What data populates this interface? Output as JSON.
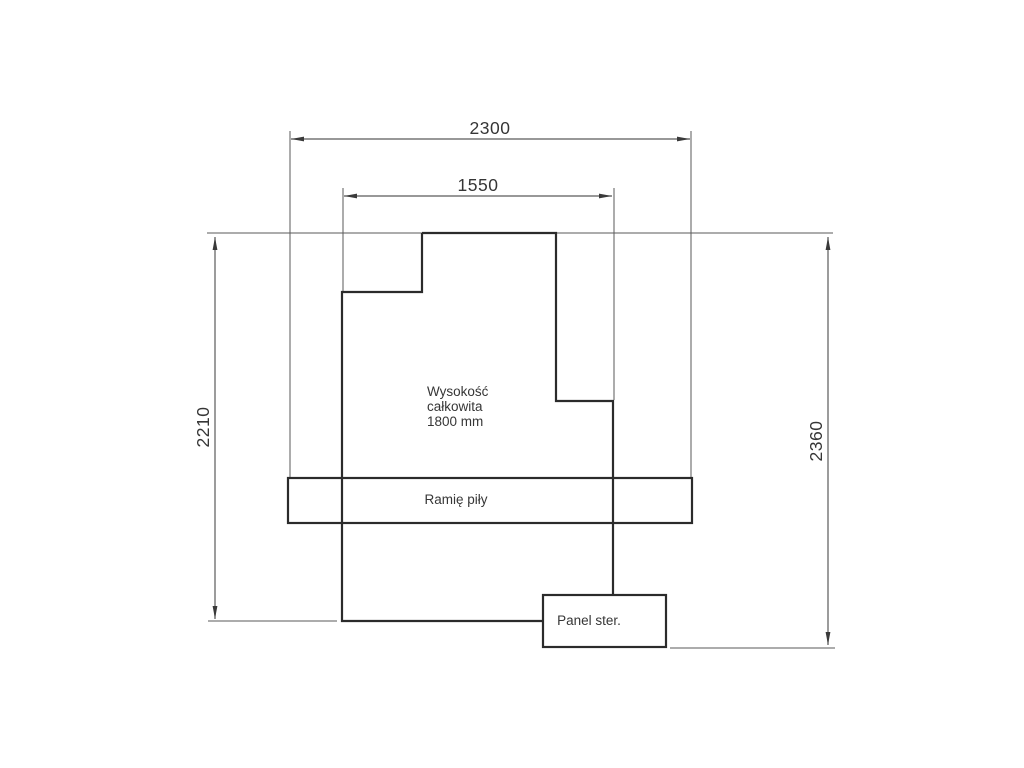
{
  "drawing": {
    "type": "technical-dimension-diagram",
    "dimensions": {
      "width_outer": "2300",
      "width_base": "1550",
      "height_body": "2210",
      "height_total": "2360"
    },
    "note": {
      "line1": "Wysokość",
      "line2": "całkowita",
      "line3": "1800 mm"
    },
    "labels": {
      "saw_arm": "Ramię piły",
      "control_panel": "Panel ster."
    },
    "colors": {
      "background": "#ffffff",
      "outline": "#2b2b2b",
      "dimension_lines": "#5a5a5a",
      "text": "#363636"
    }
  }
}
